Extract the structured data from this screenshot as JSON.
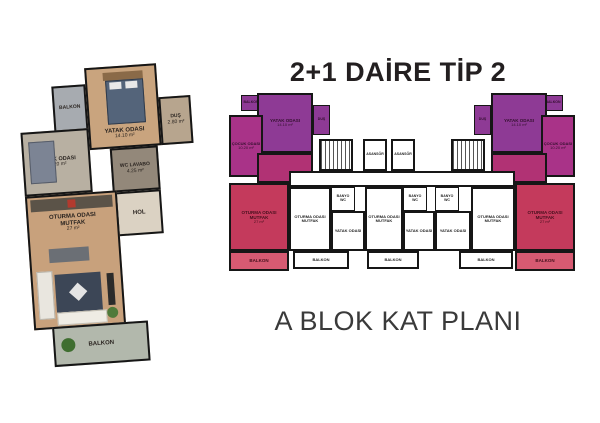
{
  "titles": {
    "plan_type": "2+1 DAİRE TİP 2",
    "block_plan": "A BLOK KAT PLANI"
  },
  "colors": {
    "unit_bedroom_purple": "#8e3a95",
    "unit_child_magenta": "#a93388",
    "unit_hall_mid": "#b13274",
    "unit_living_red": "#c43a5c",
    "unit_balcony_red_light": "#d75a72",
    "walls": "#161616",
    "title_text": "#231f20",
    "background": "#ffffff"
  },
  "detail_plan": {
    "balkon_top": "BALKON",
    "yatak_name": "YATAK ODASI",
    "yatak_area": "14.10 m²",
    "dus_name": "DUŞ",
    "dus_area": "2.80 m²",
    "cocuk_name": "ÇOCUK ODASI",
    "cocuk_area": "10.20 m²",
    "wc_name": "WC LAVABO",
    "wc_area": "4.25 m²",
    "hol": "HOL",
    "oturma_line1": "OTURMA ODASI",
    "oturma_line2": "MUTFAK",
    "oturma_area": "27 m²",
    "balkon_bottom": "BALKON"
  },
  "block_plan": {
    "corner_unit": {
      "balkon_top": "BALKON",
      "yatak_name": "YATAK ODASI",
      "yatak_area": "14.10 m²",
      "dus": "DUŞ",
      "cocuk_name": "ÇOCUK ODASI",
      "cocuk_area": "10.20 m²",
      "oturma_line1": "OTURMA ODASI",
      "oturma_line2": "MUTFAK",
      "oturma_area": "27 m²",
      "balkon": "BALKON"
    },
    "core": {
      "asansor": "ASANSÖR"
    },
    "white_unit": {
      "oturma_line1": "OTURMA ODASI",
      "oturma_line2": "MUTFAK",
      "yatak": "YATAK ODASI",
      "banyo_line1": "BANYO",
      "banyo_line2": "WC",
      "balkon": "BALKON"
    }
  }
}
